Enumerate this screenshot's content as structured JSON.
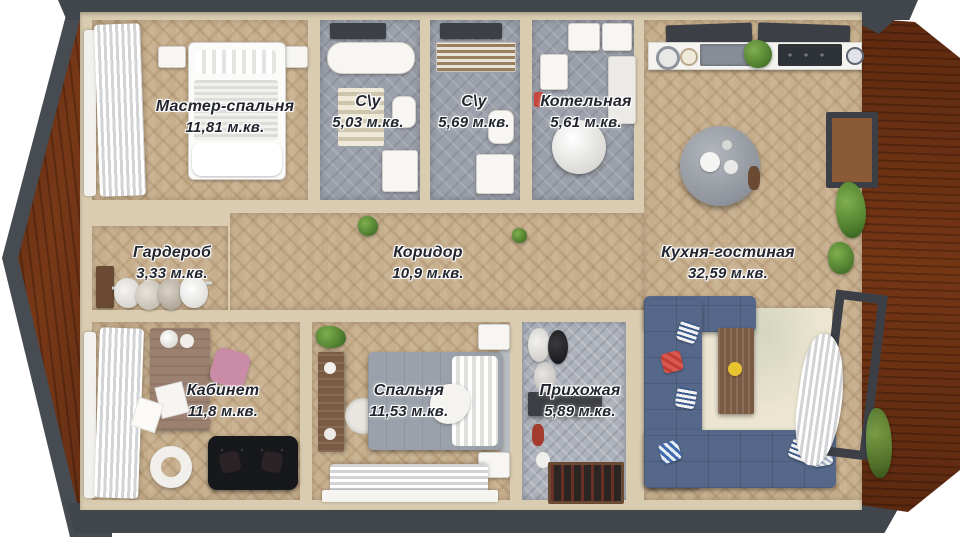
{
  "plan": {
    "kind": "apartment-floor-plan-3d-render",
    "language": "ru",
    "area_unit": "м.кв."
  },
  "rooms": [
    {
      "id": "master-bedroom",
      "name": "Мастер-спальня",
      "area": "11,81 м.кв."
    },
    {
      "id": "bathroom-1",
      "name": "С\\у",
      "area": "5,03 м.кв."
    },
    {
      "id": "bathroom-2",
      "name": "С\\у",
      "area": "5,69 м.кв."
    },
    {
      "id": "boiler-room",
      "name": "Котельная",
      "area": "5,61 м.кв."
    },
    {
      "id": "wardrobe",
      "name": "Гардероб",
      "area": "3,33 м.кв."
    },
    {
      "id": "corridor",
      "name": "Коридор",
      "area": "10,9 м.кв."
    },
    {
      "id": "kitchen-living",
      "name": "Кухня-гостиная",
      "area": "32,59 м.кв."
    },
    {
      "id": "office",
      "name": "Кабинет",
      "area": "11,8 м.кв."
    },
    {
      "id": "bedroom",
      "name": "Спальня",
      "area": "11,53 м.кв."
    },
    {
      "id": "entry-hall",
      "name": "Прихожая",
      "area": "5,89 м.кв."
    }
  ],
  "colors": {
    "exterior_wall": "#41454c",
    "deck_wood": "#a5714a",
    "interior_wall": "#d9ccb0",
    "wood_floor": "#c7af8d",
    "tile_floor": "#9ba0aa",
    "sofa_blue": "#56688a",
    "label_text": "#23262e"
  }
}
